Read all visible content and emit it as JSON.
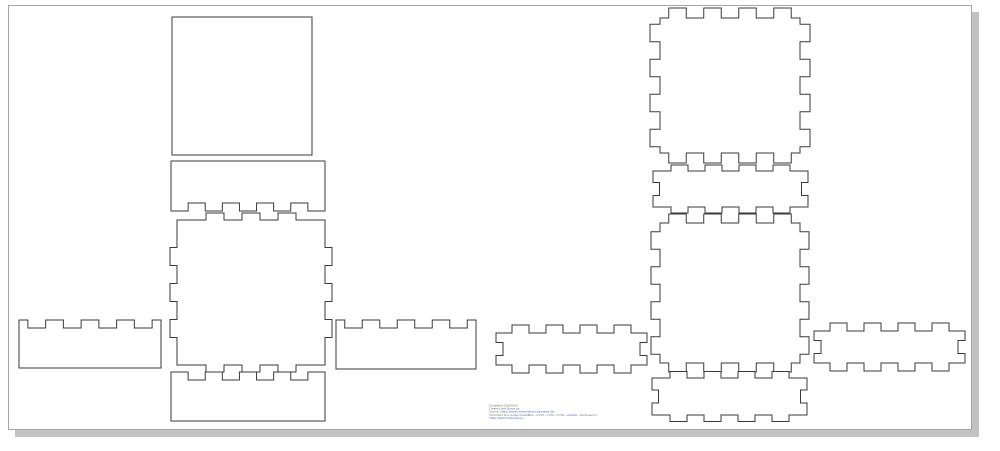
{
  "page": {
    "background": "#ffffff",
    "border_color": "#a6a6a6",
    "shadow_color": "#c2c2c2"
  },
  "drawing": {
    "stroke_color": "#3a3a3a",
    "fill_color": "#ffffff",
    "stroke_width": 1
  },
  "footer": {
    "text_color": "#6e6e6e",
    "link_color": "#4466cc",
    "lines": [
      {
        "parts": [
          {
            "t": "ClosedBox 50x50x50"
          }
        ]
      },
      {
        "parts": [
          {
            "t": "Created with Boxes.py"
          }
        ]
      },
      {
        "parts": [
          {
            "t": "Source: "
          },
          {
            "t": "https://boxes.hackerspace-bamberg.de/",
            "link": true
          }
        ]
      },
      {
        "parts": [
          {
            "t": "Command line: boxes ClosedBox --x=50 --y=50 --h=50 "
          },
          {
            "t": "--outside",
            "link": true
          },
          {
            "t": " --thickness=3"
          }
        ]
      },
      {
        "parts": [
          {
            "t": "https://festi.info/boxes.py",
            "link": true
          }
        ]
      }
    ]
  },
  "pieces": [
    {
      "id": "box1-lid",
      "group": "box-1",
      "body": {
        "x": 172,
        "y": 17,
        "w": 140,
        "h": 138
      },
      "edges": {
        "top": {
          "type": "plain"
        },
        "right": {
          "type": "plain"
        },
        "bottom": {
          "type": "plain"
        },
        "left": {
          "type": "plain"
        }
      }
    },
    {
      "id": "box1-back-wall",
      "group": "box-1",
      "body": {
        "x": 171,
        "y": 161,
        "w": 154,
        "h": 50
      },
      "edges": {
        "top": {
          "type": "plain"
        },
        "right": {
          "type": "plain"
        },
        "bottom": {
          "type": "notch",
          "count": 4,
          "unit": 17.1,
          "depth": 8
        },
        "left": {
          "type": "plain"
        }
      }
    },
    {
      "id": "box1-base",
      "group": "box-1",
      "body": {
        "x": 177,
        "y": 220,
        "w": 148,
        "h": 145
      },
      "edges": {
        "top": {
          "type": "tab",
          "count": 3,
          "unit": 18,
          "depth": 7
        },
        "right": {
          "type": "tab",
          "count": 3,
          "unit": 18,
          "depth": 7
        },
        "bottom": {
          "type": "tab",
          "count": 3,
          "unit": 18,
          "depth": 7
        },
        "left": {
          "type": "tab",
          "count": 3,
          "unit": 18,
          "depth": 7
        }
      }
    },
    {
      "id": "box1-left-wall",
      "group": "box-1",
      "body": {
        "x": 19,
        "y": 320,
        "w": 142,
        "h": 48
      },
      "edges": {
        "top": {
          "type": "notch",
          "count": 4,
          "unit": 17.75,
          "depth": 8
        },
        "right": {
          "type": "plain"
        },
        "bottom": {
          "type": "plain"
        },
        "left": {
          "type": "plain"
        }
      }
    },
    {
      "id": "box1-right-wall",
      "group": "box-1",
      "body": {
        "x": 336,
        "y": 320,
        "w": 140,
        "h": 49
      },
      "edges": {
        "top": {
          "type": "notch",
          "count": 4,
          "unit": 17.5,
          "depth": 8
        },
        "right": {
          "type": "plain"
        },
        "bottom": {
          "type": "plain"
        },
        "left": {
          "type": "plain"
        }
      }
    },
    {
      "id": "box1-front-wall",
      "group": "box-1",
      "body": {
        "x": 171,
        "y": 372,
        "w": 154,
        "h": 49
      },
      "edges": {
        "top": {
          "type": "notch",
          "count": 4,
          "unit": 17.1,
          "depth": 8
        },
        "right": {
          "type": "plain"
        },
        "bottom": {
          "type": "plain"
        },
        "left": {
          "type": "plain"
        }
      }
    },
    {
      "id": "box2-top",
      "group": "box-2",
      "body": {
        "x": 660,
        "y": 18,
        "w": 140,
        "h": 135
      },
      "edges": {
        "top": {
          "type": "tab",
          "count": 4,
          "unit": 17.5,
          "depth": 10
        },
        "right": {
          "type": "tab",
          "count": 4,
          "unit": 17.5,
          "depth": 10
        },
        "bottom": {
          "type": "tab",
          "count": 4,
          "unit": 17.5,
          "depth": 10
        },
        "left": {
          "type": "tab",
          "count": 4,
          "unit": 17.5,
          "depth": 10
        }
      }
    },
    {
      "id": "box2-back-wall",
      "group": "box-2",
      "body": {
        "x": 653,
        "y": 171,
        "w": 155,
        "h": 36
      },
      "edges": {
        "top": {
          "type": "tab",
          "count": 4,
          "unit": 17,
          "depth": 6
        },
        "right": {
          "type": "endnotch",
          "width": 13,
          "depth": 6.5
        },
        "bottom": {
          "type": "tab",
          "count": 4,
          "unit": 17,
          "depth": 6
        },
        "left": {
          "type": "endnotch",
          "width": 13,
          "depth": 6.5
        }
      }
    },
    {
      "id": "box2-base",
      "group": "box-2",
      "body": {
        "x": 660,
        "y": 223,
        "w": 140,
        "h": 140
      },
      "edges": {
        "top": {
          "type": "tab",
          "count": 4,
          "unit": 17.5,
          "depth": 9
        },
        "right": {
          "type": "tab",
          "count": 4,
          "unit": 17.5,
          "depth": 9
        },
        "bottom": {
          "type": "tab",
          "count": 4,
          "unit": 17.5,
          "depth": 9
        },
        "left": {
          "type": "tab",
          "count": 4,
          "unit": 17.5,
          "depth": 9
        }
      }
    },
    {
      "id": "box2-left-wall",
      "group": "box-2",
      "body": {
        "x": 496,
        "y": 333,
        "w": 151,
        "h": 32
      },
      "edges": {
        "top": {
          "type": "tab",
          "count": 4,
          "unit": 17,
          "depth": 8
        },
        "right": {
          "type": "endnotch",
          "width": 13,
          "depth": 7
        },
        "bottom": {
          "type": "tab",
          "count": 4,
          "unit": 17,
          "depth": 8
        },
        "left": {
          "type": "endnotch",
          "width": 13,
          "depth": 7
        }
      }
    },
    {
      "id": "box2-right-wall",
      "group": "box-2",
      "body": {
        "x": 814,
        "y": 331,
        "w": 151,
        "h": 32
      },
      "edges": {
        "top": {
          "type": "tab",
          "count": 4,
          "unit": 17,
          "depth": 8
        },
        "right": {
          "type": "endnotch",
          "width": 13,
          "depth": 7
        },
        "bottom": {
          "type": "tab",
          "count": 4,
          "unit": 17,
          "depth": 8
        },
        "left": {
          "type": "endnotch",
          "width": 13,
          "depth": 7
        }
      }
    },
    {
      "id": "box2-front-wall",
      "group": "box-2",
      "body": {
        "x": 652,
        "y": 378,
        "w": 155,
        "h": 37
      },
      "edges": {
        "top": {
          "type": "tab",
          "count": 4,
          "unit": 17,
          "depth": 6.5
        },
        "right": {
          "type": "endnotch",
          "width": 13,
          "depth": 6.5
        },
        "bottom": {
          "type": "tab",
          "count": 4,
          "unit": 17,
          "depth": 6.5
        },
        "left": {
          "type": "endnotch",
          "width": 13,
          "depth": 6.5
        }
      }
    }
  ]
}
